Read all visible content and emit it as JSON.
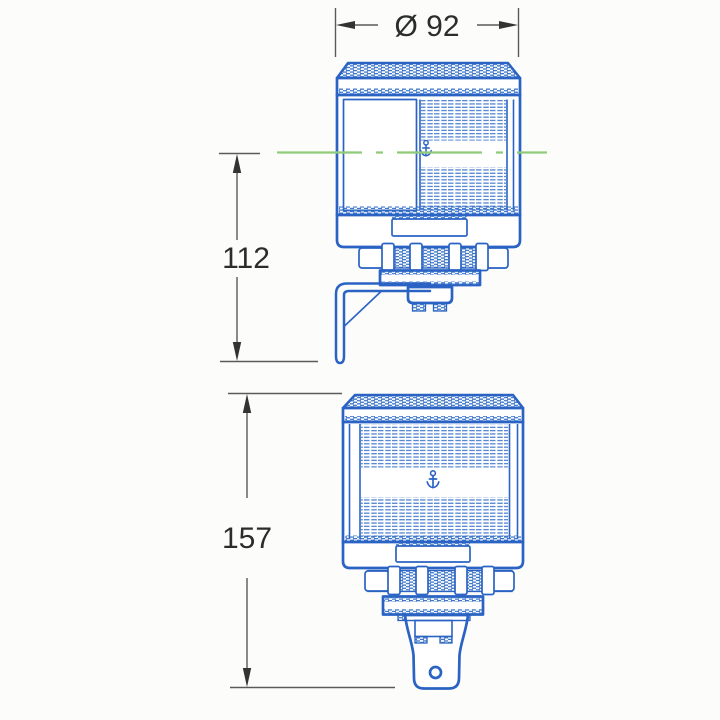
{
  "colors": {
    "line_blue": "#2a63c4",
    "lens_blue": "#4179cd",
    "texture_blue": "#3570c8",
    "centerline_green": "#8fcb7b",
    "dimension_line": "#5a5a5a",
    "text_color": "#2a2d2b",
    "background": "#fcfcfa"
  },
  "dimensions": {
    "diameter_label": "Ø 92",
    "side_view_height_label": "112",
    "front_view_height_label": "157"
  },
  "icons": {
    "top_lamp_symbol": "anchor-icon",
    "bottom_lamp_symbol": "anchor-icon"
  }
}
